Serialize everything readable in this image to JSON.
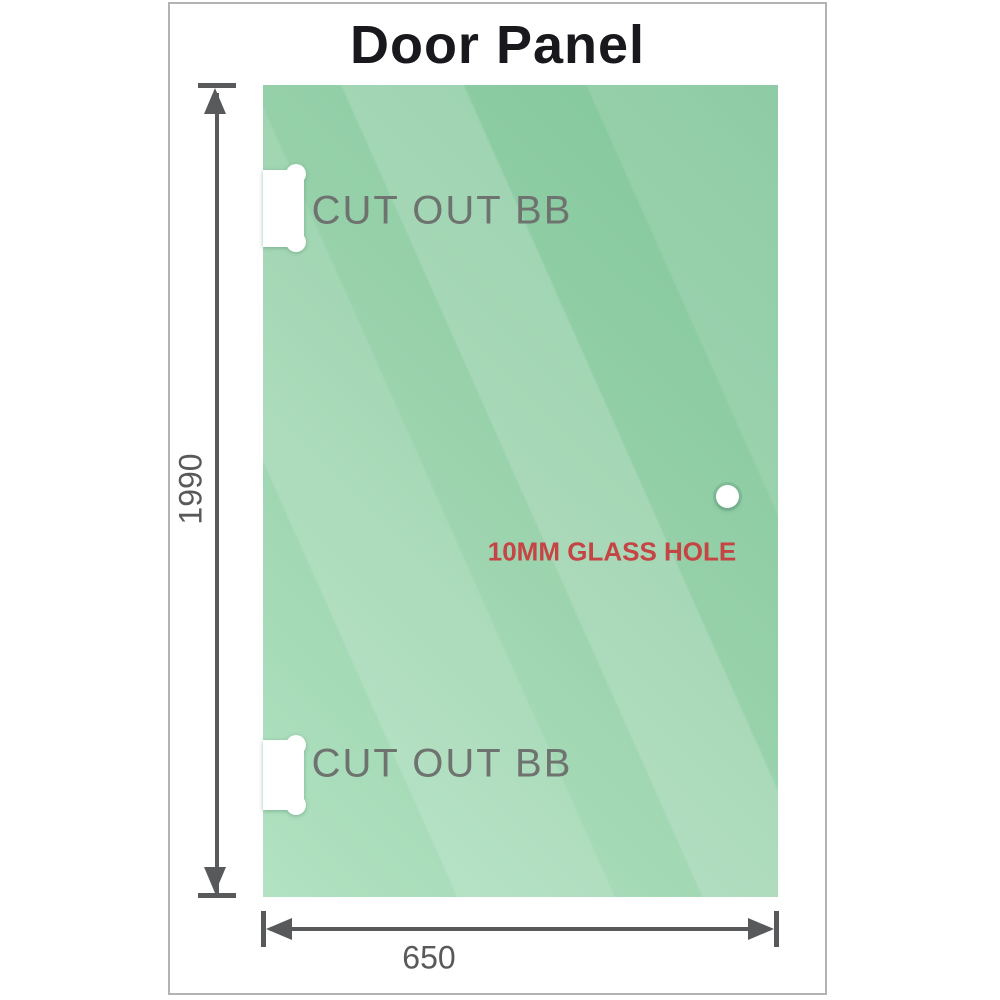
{
  "title": "Door Panel",
  "dimensions": {
    "height_mm": "1990",
    "width_mm": "650"
  },
  "annotations": {
    "cutout_top": "CUT OUT BB",
    "cutout_bottom": "CUT OUT BB",
    "glass_hole": "10MM GLASS HOLE"
  },
  "colors": {
    "glass_dark": "#7fc599",
    "glass_mid": "#93cfa7",
    "glass_light": "#b2e2c2",
    "dimension_line": "#58595b",
    "annotation_gray": "#6e7370",
    "annotation_red": "#c54444",
    "frame_border": "#b3b3b3",
    "title_text": "#18181d"
  }
}
